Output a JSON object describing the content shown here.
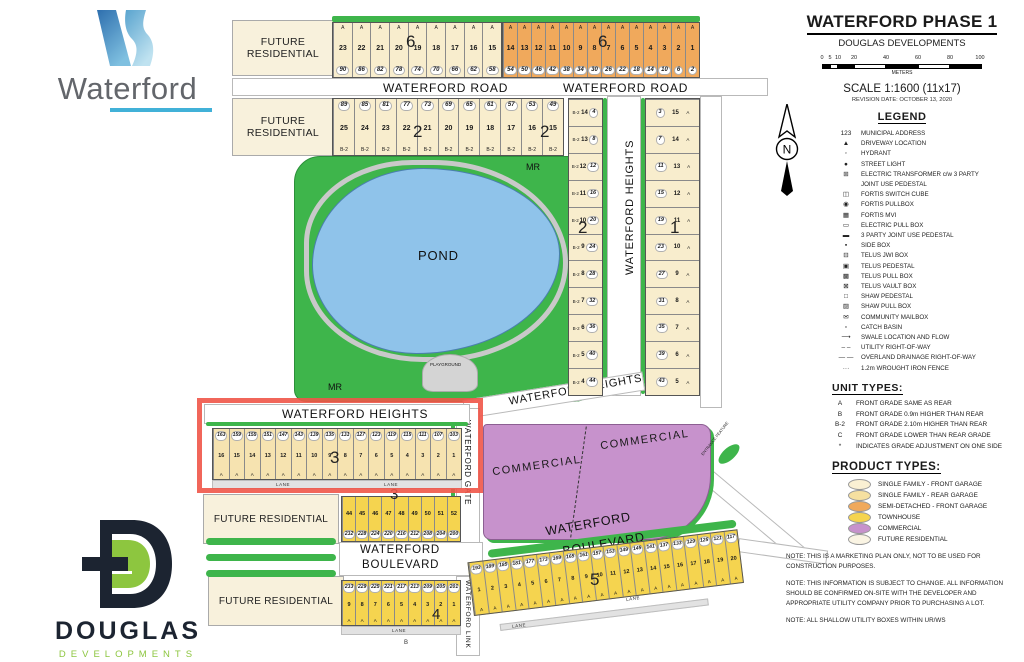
{
  "branding": {
    "waterford_word": "Waterford",
    "douglas_word": "DOUGLAS",
    "douglas_sub": "DEVELOPMENTS"
  },
  "title_panel": {
    "title": "WATERFORD PHASE 1",
    "subtitle": "DOUGLAS DEVELOPMENTS",
    "scale_ticks": [
      "0",
      "5",
      "10",
      "20",
      "40",
      "60",
      "80",
      "100"
    ],
    "scale_unit": "METERS",
    "scale_text": "SCALE 1:1600 (11x17)",
    "revision": "REVISION DATE: OCTOBER 13, 2020"
  },
  "legend": {
    "heading": "LEGEND",
    "items": [
      {
        "icon": "123",
        "label": "MUNICIPAL ADDRESS"
      },
      {
        "icon": "▲",
        "label": "DRIVEWAY LOCATION"
      },
      {
        "icon": "◦",
        "label": "HYDRANT"
      },
      {
        "icon": "●",
        "label": "STREET LIGHT"
      },
      {
        "icon": "⊞",
        "label": "ELECTRIC TRANSFORMER c/w 3 PARTY JOINT USE PEDESTAL"
      },
      {
        "icon": "◫",
        "label": "FORTIS SWITCH CUBE"
      },
      {
        "icon": "◉",
        "label": "FORTIS PULLBOX"
      },
      {
        "icon": "▦",
        "label": "FORTIS MVI"
      },
      {
        "icon": "▭",
        "label": "ELECTRIC PULL BOX"
      },
      {
        "icon": "▬",
        "label": "3 PARTY JOINT USE PEDESTAL"
      },
      {
        "icon": "▪",
        "label": "SIDE BOX"
      },
      {
        "icon": "⊟",
        "label": "TELUS JWI BOX"
      },
      {
        "icon": "▣",
        "label": "TELUS PEDESTAL"
      },
      {
        "icon": "▩",
        "label": "TELUS PULL BOX"
      },
      {
        "icon": "⊠",
        "label": "TELUS VAULT BOX"
      },
      {
        "icon": "□",
        "label": "SHAW PEDESTAL"
      },
      {
        "icon": "▨",
        "label": "SHAW PULL BOX"
      },
      {
        "icon": "✉",
        "label": "COMMUNITY MAILBOX"
      },
      {
        "icon": "▫",
        "label": "CATCH BASIN"
      },
      {
        "icon": "⟶",
        "label": "SWALE LOCATION AND FLOW"
      },
      {
        "icon": "– –",
        "label": "UTILITY RIGHT-OF-WAY"
      },
      {
        "icon": "— —",
        "label": "OVERLAND DRAINAGE RIGHT-OF-WAY"
      },
      {
        "icon": "···",
        "label": "1.2m WROUGHT IRON FENCE"
      }
    ]
  },
  "unit_types": {
    "heading": "UNIT TYPES:",
    "items": [
      {
        "code": "A",
        "desc": "FRONT GRADE SAME AS REAR"
      },
      {
        "code": "B",
        "desc": "FRONT GRADE 0.9m HIGHER THAN REAR"
      },
      {
        "code": "B-2",
        "desc": "FRONT GRADE 2.10m HIGHER THAN REAR"
      },
      {
        "code": "C",
        "desc": "FRONT GRADE LOWER THAN REAR GRADE"
      },
      {
        "code": "*",
        "desc": "INDICATES GRADE ADJUSTMENT ON ONE SIDE"
      }
    ]
  },
  "product_types": {
    "heading": "PRODUCT TYPES:",
    "items": [
      {
        "color": "#faf0d3",
        "label": "SINGLE FAMILY - FRONT GARAGE"
      },
      {
        "color": "#f6e0a0",
        "label": "SINGLE FAMILY - REAR GARAGE"
      },
      {
        "color": "#f0a95c",
        "label": "SEMI-DETACHED - FRONT GARAGE"
      },
      {
        "color": "#f5d44f",
        "label": "TOWNHOUSE"
      },
      {
        "color": "#c792cc",
        "label": "COMMERCIAL"
      },
      {
        "color": "#faf4e3",
        "label": "FUTURE RESIDENTIAL"
      }
    ]
  },
  "notes": [
    "NOTE: THIS IS A MARKETING PLAN ONLY, NOT TO BE USED FOR CONSTRUCTION PURPOSES.",
    "NOTE: THIS INFORMATION IS SUBJECT TO CHANGE. ALL INFORMATION SHOULD BE CONFIRMED ON-SITE WITH THE DEVELOPER AND APPROPRIATE UTILITY COMPANY PRIOR TO PURCHASING A LOT.",
    "NOTE: ALL SHALLOW UTILITY BOXES WITHIN UR/WS"
  ],
  "map": {
    "north_label": "N",
    "labels": {
      "waterford_road_1": "WATERFORD ROAD",
      "waterford_road_2": "WATERFORD ROAD",
      "waterford_heights_v": "WATERFORD HEIGHTS",
      "waterford_heights_diag": "WATERFORD HEIGHTS",
      "waterford_heights_red": "WATERFORD HEIGHTS",
      "waterford_gate": "WATERFORD GATE",
      "waterford_link": "WATERFORD LINK",
      "waterford_blvd_line1": "WATERFORD",
      "waterford_blvd_line2": "BOULEVARD",
      "waterford_blvd_diag1": "WATERFORD",
      "waterford_blvd_diag2": "BOULEVARD",
      "pond": "POND",
      "playground": "PLAYGROUND",
      "mr1": "MR",
      "mr2": "MR",
      "commercial_1": "COMMERCIAL",
      "commercial_2": "COMMERCIAL",
      "entrance_feature": "ENTRANCE FEATURE",
      "future_residential": "FUTURE RESIDENTIAL",
      "lane": "LANE",
      "b_marker": "B"
    },
    "block_labels": {
      "b6a": "6",
      "b6b": "6",
      "b2a": "2",
      "b2b": "2",
      "b2c": "2",
      "b1": "1",
      "b3a": "3",
      "b3b": "3",
      "b4": "4",
      "b5": "5"
    },
    "lot_rows": {
      "block6_west": [
        {
          "l": "23",
          "a": "90",
          "t": "A"
        },
        {
          "l": "22",
          "a": "86",
          "t": "A"
        },
        {
          "l": "21",
          "a": "82",
          "t": "A"
        },
        {
          "l": "20",
          "a": "78",
          "t": "A"
        },
        {
          "l": "19",
          "a": "74",
          "t": "A"
        },
        {
          "l": "18",
          "a": "70",
          "t": "A"
        },
        {
          "l": "17",
          "a": "66",
          "t": "A"
        },
        {
          "l": "16",
          "a": "62",
          "t": "A"
        },
        {
          "l": "15",
          "a": "58",
          "t": "A"
        }
      ],
      "block6_east": [
        {
          "l": "14",
          "a": "54",
          "t": "A"
        },
        {
          "l": "13",
          "a": "50",
          "t": "A"
        },
        {
          "l": "12",
          "a": "46",
          "t": "A"
        },
        {
          "l": "11",
          "a": "42",
          "t": "A"
        },
        {
          "l": "10",
          "a": "38",
          "t": "A"
        },
        {
          "l": "9",
          "a": "34",
          "t": "A"
        },
        {
          "l": "8",
          "a": "30",
          "t": "A"
        },
        {
          "l": "7",
          "a": "26",
          "t": "A"
        },
        {
          "l": "6",
          "a": "22",
          "t": "A"
        },
        {
          "l": "5",
          "a": "18",
          "t": "A"
        },
        {
          "l": "4",
          "a": "14",
          "t": "A"
        },
        {
          "l": "3",
          "a": "10",
          "t": "A"
        },
        {
          "l": "2",
          "a": "6",
          "t": "A"
        },
        {
          "l": "1",
          "a": "2",
          "t": "A"
        }
      ],
      "block2_row": [
        {
          "l": "25",
          "a": "89",
          "t": "B-2"
        },
        {
          "l": "24",
          "a": "85",
          "t": "B-2"
        },
        {
          "l": "23",
          "a": "81",
          "t": "B-2"
        },
        {
          "l": "22",
          "a": "77",
          "t": "B-2"
        },
        {
          "l": "21",
          "a": "73",
          "t": "B-2"
        },
        {
          "l": "20",
          "a": "69",
          "t": "B-2"
        },
        {
          "l": "19",
          "a": "65",
          "t": "B-2"
        },
        {
          "l": "18",
          "a": "61",
          "t": "B-2"
        },
        {
          "l": "17",
          "a": "57",
          "t": "B-2"
        },
        {
          "l": "16",
          "a": "53",
          "t": "B-2"
        },
        {
          "l": "15",
          "a": "49",
          "t": "B-2"
        }
      ],
      "block2_col": [
        {
          "l": "14",
          "a": "4",
          "t": "B-2"
        },
        {
          "l": "13",
          "a": "8",
          "t": "B-2"
        },
        {
          "l": "12",
          "a": "12",
          "t": "B-2"
        },
        {
          "l": "11",
          "a": "16",
          "t": "B-2"
        },
        {
          "l": "10",
          "a": "20",
          "t": "B-2"
        },
        {
          "l": "9",
          "a": "24",
          "t": "B-2"
        },
        {
          "l": "8",
          "a": "28",
          "t": "B-2"
        },
        {
          "l": "7",
          "a": "32",
          "t": "B-2"
        },
        {
          "l": "6",
          "a": "36",
          "t": "B-2"
        },
        {
          "l": "5",
          "a": "40",
          "t": "B-2"
        },
        {
          "l": "4",
          "a": "44",
          "t": "B-2"
        }
      ],
      "block1_col": [
        {
          "l": "15",
          "a": "3",
          "t": "A"
        },
        {
          "l": "14",
          "a": "7",
          "t": "A"
        },
        {
          "l": "13",
          "a": "11",
          "t": "A"
        },
        {
          "l": "12",
          "a": "15",
          "t": "A"
        },
        {
          "l": "11",
          "a": "19",
          "t": "A"
        },
        {
          "l": "10",
          "a": "23",
          "t": "A"
        },
        {
          "l": "9",
          "a": "27",
          "t": "A"
        },
        {
          "l": "8",
          "a": "31",
          "t": "A"
        },
        {
          "l": "7",
          "a": "35",
          "t": "A"
        },
        {
          "l": "6",
          "a": "39",
          "t": "A"
        },
        {
          "l": "5",
          "a": "43",
          "t": "A"
        }
      ],
      "block3_red": [
        {
          "l": "16",
          "a": "163",
          "t": "A"
        },
        {
          "l": "15",
          "a": "159",
          "t": "A"
        },
        {
          "l": "14",
          "a": "155",
          "t": "A"
        },
        {
          "l": "13",
          "a": "151",
          "t": "A"
        },
        {
          "l": "12",
          "a": "147",
          "t": "A"
        },
        {
          "l": "11",
          "a": "143",
          "t": "A"
        },
        {
          "l": "10",
          "a": "139",
          "t": "A"
        },
        {
          "l": "9",
          "a": "135",
          "t": "A"
        },
        {
          "l": "8",
          "a": "131",
          "t": "A"
        },
        {
          "l": "7",
          "a": "127",
          "t": "A"
        },
        {
          "l": "6",
          "a": "123",
          "t": "A"
        },
        {
          "l": "5",
          "a": "119",
          "t": "A"
        },
        {
          "l": "4",
          "a": "115",
          "t": "A"
        },
        {
          "l": "3",
          "a": "111",
          "t": "A"
        },
        {
          "l": "2",
          "a": "107",
          "t": "A"
        },
        {
          "l": "1",
          "a": "103",
          "t": "A"
        }
      ],
      "block3_th": [
        {
          "l": "44",
          "a": "232"
        },
        {
          "l": "45",
          "a": "228"
        },
        {
          "l": "46",
          "a": "224"
        },
        {
          "l": "47",
          "a": "220"
        },
        {
          "l": "48",
          "a": "216"
        },
        {
          "l": "49",
          "a": "212"
        },
        {
          "l": "50",
          "a": "208"
        },
        {
          "l": "51",
          "a": "204"
        },
        {
          "l": "52",
          "a": "200"
        }
      ],
      "block4_th": [
        {
          "l": "9",
          "a": "233",
          "t": "A"
        },
        {
          "l": "8",
          "a": "229",
          "t": "A"
        },
        {
          "l": "7",
          "a": "225",
          "t": "A"
        },
        {
          "l": "6",
          "a": "221",
          "t": "A"
        },
        {
          "l": "5",
          "a": "217",
          "t": "A"
        },
        {
          "l": "4",
          "a": "213",
          "t": "A"
        },
        {
          "l": "3",
          "a": "209",
          "t": "A"
        },
        {
          "l": "2",
          "a": "205",
          "t": "A"
        },
        {
          "l": "1",
          "a": "201",
          "t": "A"
        }
      ],
      "block5_row": [
        {
          "l": "1",
          "a": "193",
          "t": "A"
        },
        {
          "l": "2",
          "a": "189",
          "t": "A"
        },
        {
          "l": "3",
          "a": "185",
          "t": "A"
        },
        {
          "l": "4",
          "a": "181",
          "t": "A"
        },
        {
          "l": "5",
          "a": "177",
          "t": "A"
        },
        {
          "l": "6",
          "a": "173",
          "t": "A"
        },
        {
          "l": "7",
          "a": "169",
          "t": "A"
        },
        {
          "l": "8",
          "a": "165",
          "t": "A"
        },
        {
          "l": "9",
          "a": "161",
          "t": "A"
        },
        {
          "l": "10",
          "a": "157",
          "t": "A"
        },
        {
          "l": "11",
          "a": "153",
          "t": "A"
        },
        {
          "l": "12",
          "a": "149",
          "t": "A"
        },
        {
          "l": "13",
          "a": "145",
          "t": "A"
        },
        {
          "l": "14",
          "a": "141",
          "t": "A"
        },
        {
          "l": "15",
          "a": "137",
          "t": "A"
        },
        {
          "l": "16",
          "a": "133",
          "t": "A"
        },
        {
          "l": "17",
          "a": "129",
          "t": "A"
        },
        {
          "l": "18",
          "a": "125",
          "t": "A"
        },
        {
          "l": "19",
          "a": "121",
          "t": "A"
        },
        {
          "l": "20",
          "a": "117",
          "t": "A"
        }
      ]
    },
    "colors": {
      "park_green": "#3eb54b",
      "pond_blue": "#8fc3ea",
      "commercial_purple": "#c792cc",
      "semi_detached_orange": "#f0a95c",
      "townhouse_yellow": "#f5d44f",
      "highlight_red": "#f05548"
    }
  }
}
